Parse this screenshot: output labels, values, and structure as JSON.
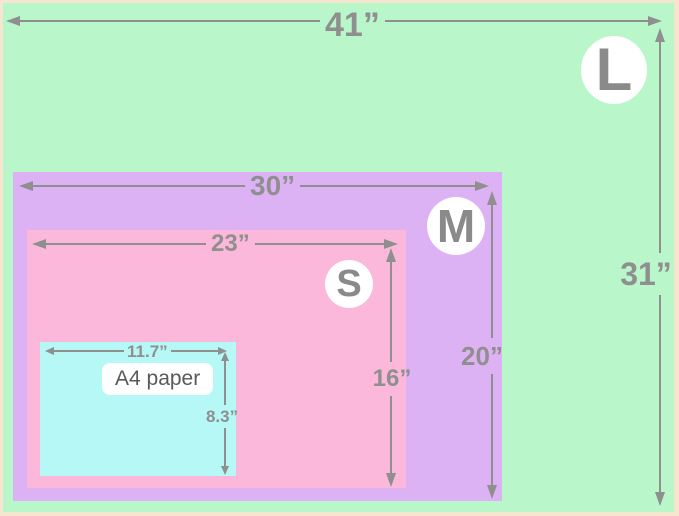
{
  "diagram": {
    "kind": "nested-size-comparison",
    "frame_color": "#f7e6cf",
    "line_color": "#8f8f8f",
    "badge_text_color": "#8a8a8a",
    "a4_label_text_color": "#595959"
  },
  "sizes": [
    {
      "code": "L",
      "width_label": "41”",
      "height_label": "31”",
      "color": "#b9f6c9"
    },
    {
      "code": "M",
      "width_label": "30”",
      "height_label": "20”",
      "color": "#dcb2f4"
    },
    {
      "code": "S",
      "width_label": "23”",
      "height_label": "16”",
      "color": "#fcb8db"
    },
    {
      "code": "A4",
      "name": "A4 paper",
      "width_label": "11.7”",
      "height_label": "8.3”",
      "color": "#b6f8f6"
    }
  ]
}
